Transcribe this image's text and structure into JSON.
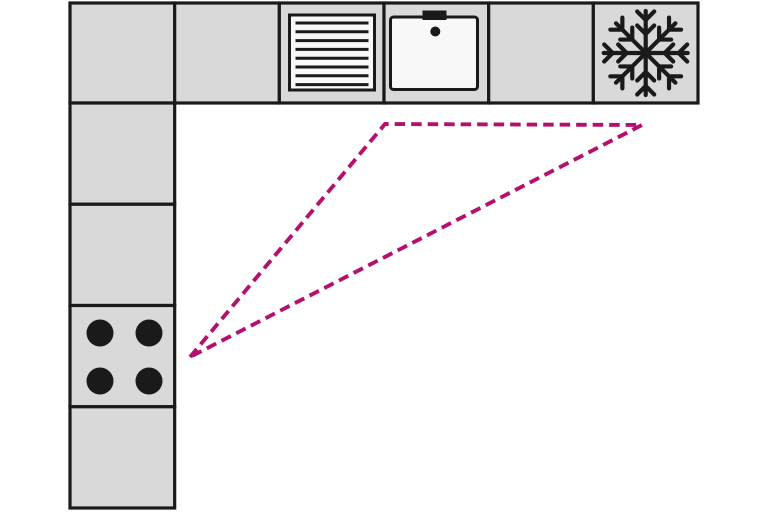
{
  "diagram": {
    "type": "kitchen-floor-plan",
    "layout": "L-shaped",
    "colors": {
      "background": "#ffffff",
      "cabinet_fill": "#d9d9d9",
      "outline": "#1a1a1a",
      "appliance_fill": "#f8f8f8",
      "triangle_stroke": "#b6106f"
    },
    "top_row_cells": [
      "cabinet",
      "cabinet",
      "vent-grille",
      "sink",
      "cabinet",
      "refrigerator-freezer"
    ],
    "left_column_cells": [
      "corner-cabinet",
      "cabinet",
      "cabinet",
      "cooktop",
      "cabinet"
    ],
    "appliances": [
      {
        "name": "vent-grille",
        "icon": "horizontal-slats-icon"
      },
      {
        "name": "sink",
        "icon": "basin-with-tap-icon"
      },
      {
        "name": "refrigerator-freezer",
        "icon": "snowflake-icon"
      },
      {
        "name": "cooktop",
        "icon": "four-burners-icon"
      }
    ],
    "work_triangle": {
      "connects": [
        "cooktop",
        "sink",
        "refrigerator-freezer"
      ],
      "style": "dashed",
      "points": "190,357 385,124 642,125"
    }
  }
}
